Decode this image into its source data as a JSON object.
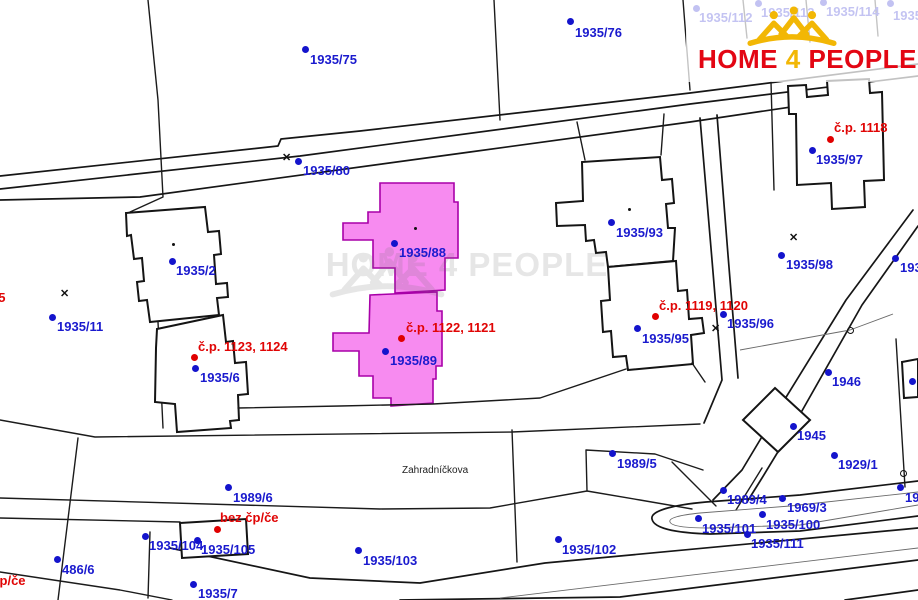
{
  "watermark": {
    "text": "HOME 4 PEOPLE"
  },
  "logo": {
    "home": "HOME",
    "four": "4",
    "people": "PEOPLE",
    "red": "#e30613",
    "gold": "#f2b705"
  },
  "map": {
    "highlight_color": "#f78bf0",
    "labels": [
      {
        "text": "1935/75",
        "color": "blue",
        "x": 310,
        "y": 53
      },
      {
        "text": "1935/76",
        "color": "blue",
        "x": 575,
        "y": 26
      },
      {
        "text": "1935/80",
        "color": "blue",
        "x": 303,
        "y": 164
      },
      {
        "text": "1935/88",
        "color": "blue",
        "x": 399,
        "y": 246
      },
      {
        "text": "č.p. 1122, 1121",
        "color": "red",
        "x": 406,
        "y": 321
      },
      {
        "text": "1935/89",
        "color": "blue",
        "x": 390,
        "y": 354
      },
      {
        "text": "1935/2",
        "color": "blue",
        "x": 176,
        "y": 264
      },
      {
        "text": "1935/11",
        "color": "blue",
        "x": 57,
        "y": 320
      },
      {
        "text": "25",
        "color": "red",
        "x": -9,
        "y": 291
      },
      {
        "text": "č.p. 1123, 1124",
        "color": "red",
        "x": 198,
        "y": 340
      },
      {
        "text": "1935/6",
        "color": "blue",
        "x": 200,
        "y": 371
      },
      {
        "text": "1935/93",
        "color": "blue",
        "x": 616,
        "y": 226
      },
      {
        "text": "č.p. 1119, 1120",
        "color": "red",
        "x": 659,
        "y": 299
      },
      {
        "text": "1935/95",
        "color": "blue",
        "x": 642,
        "y": 332
      },
      {
        "text": "1935/96",
        "color": "blue",
        "x": 727,
        "y": 317
      },
      {
        "text": "1935/98",
        "color": "blue",
        "x": 786,
        "y": 258
      },
      {
        "text": "č.p. 1118",
        "color": "red",
        "x": 834,
        "y": 121
      },
      {
        "text": "1935/97",
        "color": "blue",
        "x": 816,
        "y": 153
      },
      {
        "text": "1935/",
        "color": "blue",
        "x": 900,
        "y": 261
      },
      {
        "text": "1946",
        "color": "blue",
        "x": 832,
        "y": 375
      },
      {
        "text": "1945",
        "color": "blue",
        "x": 797,
        "y": 429
      },
      {
        "text": "1929/1",
        "color": "blue",
        "x": 838,
        "y": 458
      },
      {
        "text": "1989/5",
        "color": "blue",
        "x": 617,
        "y": 457
      },
      {
        "text": "Zahradníčkova",
        "color": "street",
        "x": 402,
        "y": 465
      },
      {
        "text": "1989/6",
        "color": "blue",
        "x": 233,
        "y": 491
      },
      {
        "text": "bez čp/če",
        "color": "red",
        "x": 220,
        "y": 511
      },
      {
        "text": "1935/104",
        "color": "blue",
        "x": 149,
        "y": 539
      },
      {
        "text": "1935/105",
        "color": "blue",
        "x": 201,
        "y": 543
      },
      {
        "text": "1935/103",
        "color": "blue",
        "x": 363,
        "y": 554
      },
      {
        "text": "1935/7",
        "color": "blue",
        "x": 198,
        "y": 587
      },
      {
        "text": "486/6",
        "color": "blue",
        "x": 62,
        "y": 563
      },
      {
        "text": "bez čp/če",
        "color": "red",
        "x": -33,
        "y": 574
      },
      {
        "text": "1935/102",
        "color": "blue",
        "x": 562,
        "y": 543
      },
      {
        "text": "1989/4",
        "color": "blue",
        "x": 727,
        "y": 493
      },
      {
        "text": "1969/3",
        "color": "blue",
        "x": 787,
        "y": 501
      },
      {
        "text": "1935/101",
        "color": "blue",
        "x": 702,
        "y": 522
      },
      {
        "text": "1935/100",
        "color": "blue",
        "x": 766,
        "y": 518
      },
      {
        "text": "1935/111",
        "color": "blue",
        "x": 751,
        "y": 537
      },
      {
        "text": "19",
        "color": "blue",
        "x": 905,
        "y": 491
      },
      {
        "text": "1935/112",
        "color": "blue",
        "x": 699,
        "y": 11
      },
      {
        "text": "1935/113",
        "color": "blue",
        "x": 761,
        "y": 6
      },
      {
        "text": "1935/114",
        "color": "blue",
        "x": 826,
        "y": 5
      },
      {
        "text": "1935/115",
        "color": "blue",
        "x": 893,
        "y": 9
      }
    ],
    "dots": [
      {
        "x": 305,
        "y": 49,
        "color": "blue"
      },
      {
        "x": 570,
        "y": 21,
        "color": "blue"
      },
      {
        "x": 298,
        "y": 161,
        "color": "blue"
      },
      {
        "x": 394,
        "y": 243,
        "color": "blue"
      },
      {
        "x": 385,
        "y": 351,
        "color": "blue"
      },
      {
        "x": 172,
        "y": 261,
        "color": "blue"
      },
      {
        "x": 52,
        "y": 317,
        "color": "blue"
      },
      {
        "x": 195,
        "y": 368,
        "color": "blue"
      },
      {
        "x": 611,
        "y": 222,
        "color": "blue"
      },
      {
        "x": 637,
        "y": 328,
        "color": "blue"
      },
      {
        "x": 723,
        "y": 314,
        "color": "blue"
      },
      {
        "x": 781,
        "y": 255,
        "color": "blue"
      },
      {
        "x": 812,
        "y": 150,
        "color": "blue"
      },
      {
        "x": 895,
        "y": 258,
        "color": "blue"
      },
      {
        "x": 828,
        "y": 372,
        "color": "blue"
      },
      {
        "x": 793,
        "y": 426,
        "color": "blue"
      },
      {
        "x": 834,
        "y": 455,
        "color": "blue"
      },
      {
        "x": 612,
        "y": 453,
        "color": "blue"
      },
      {
        "x": 228,
        "y": 487,
        "color": "blue"
      },
      {
        "x": 145,
        "y": 536,
        "color": "blue"
      },
      {
        "x": 197,
        "y": 540,
        "color": "blue"
      },
      {
        "x": 358,
        "y": 550,
        "color": "blue"
      },
      {
        "x": 193,
        "y": 584,
        "color": "blue"
      },
      {
        "x": 57,
        "y": 559,
        "color": "blue"
      },
      {
        "x": 558,
        "y": 539,
        "color": "blue"
      },
      {
        "x": 723,
        "y": 490,
        "color": "blue"
      },
      {
        "x": 782,
        "y": 498,
        "color": "blue"
      },
      {
        "x": 698,
        "y": 518,
        "color": "blue"
      },
      {
        "x": 762,
        "y": 514,
        "color": "blue"
      },
      {
        "x": 747,
        "y": 534,
        "color": "blue"
      },
      {
        "x": 900,
        "y": 487,
        "color": "blue"
      },
      {
        "x": 912,
        "y": 381,
        "color": "blue"
      },
      {
        "x": 696,
        "y": 8,
        "color": "blue"
      },
      {
        "x": 758,
        "y": 3,
        "color": "blue"
      },
      {
        "x": 823,
        "y": 2,
        "color": "blue"
      },
      {
        "x": 890,
        "y": 3,
        "color": "blue"
      },
      {
        "x": 401,
        "y": 338,
        "color": "red"
      },
      {
        "x": 194,
        "y": 357,
        "color": "red"
      },
      {
        "x": 655,
        "y": 316,
        "color": "red"
      },
      {
        "x": 830,
        "y": 139,
        "color": "red"
      },
      {
        "x": 217,
        "y": 529,
        "color": "red"
      }
    ],
    "crosses": [
      {
        "x": 287,
        "y": 158
      },
      {
        "x": 65,
        "y": 294
      },
      {
        "x": 716,
        "y": 329
      },
      {
        "x": 794,
        "y": 238
      }
    ],
    "rings": [
      {
        "x": 850,
        "y": 330
      },
      {
        "x": 903,
        "y": 473
      }
    ],
    "point_dots": [
      {
        "x": 173,
        "y": 244
      },
      {
        "x": 415,
        "y": 228
      },
      {
        "x": 629,
        "y": 209
      }
    ]
  }
}
